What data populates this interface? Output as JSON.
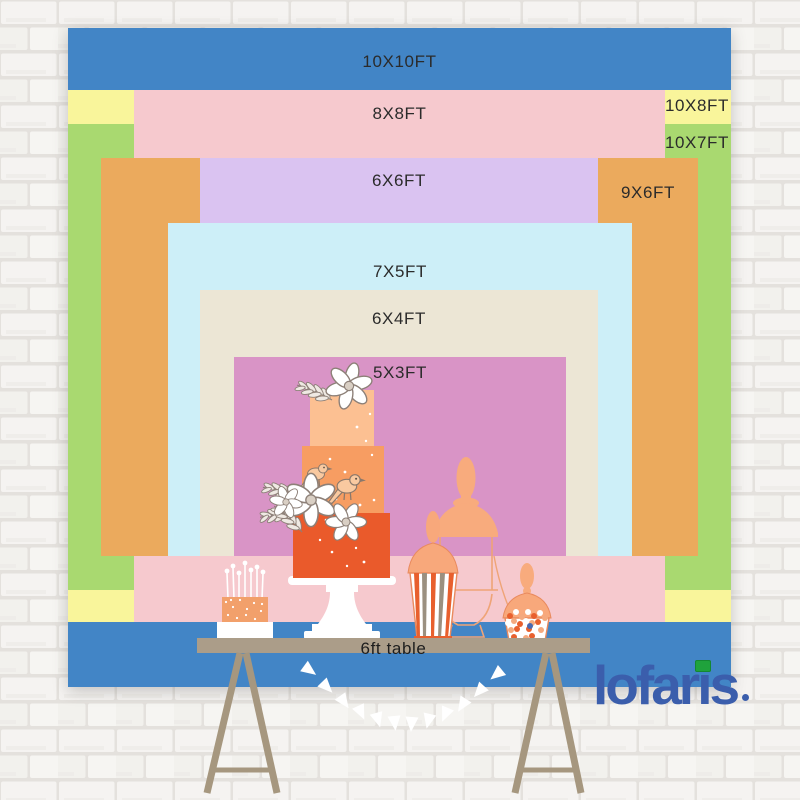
{
  "sizes": [
    {
      "label": "10X10FT",
      "color": "#4285c6"
    },
    {
      "label": "8X8FT",
      "color": "#f6c9ce"
    },
    {
      "label": "10X8FT",
      "color": "#f9f59b"
    },
    {
      "label": "10X7FT",
      "color": "#a9d970"
    },
    {
      "label": "6X6FT",
      "color": "#dac3f1"
    },
    {
      "label": "9X6FT",
      "color": "#ebaa5d"
    },
    {
      "label": "7X5FT",
      "color": "#cdeff8"
    },
    {
      "label": "6X4FT",
      "color": "#ece6d5"
    },
    {
      "label": "5X3FT",
      "color": "#d994c6"
    }
  ],
  "table": {
    "label": "6ft table",
    "color": "#ab9d89"
  },
  "logo": {
    "text": "lofaris",
    "part1": "lofar",
    "part2": "i",
    "part3": "s",
    "color": "#3b5eac",
    "i_dot_color": "#1fa23c"
  }
}
